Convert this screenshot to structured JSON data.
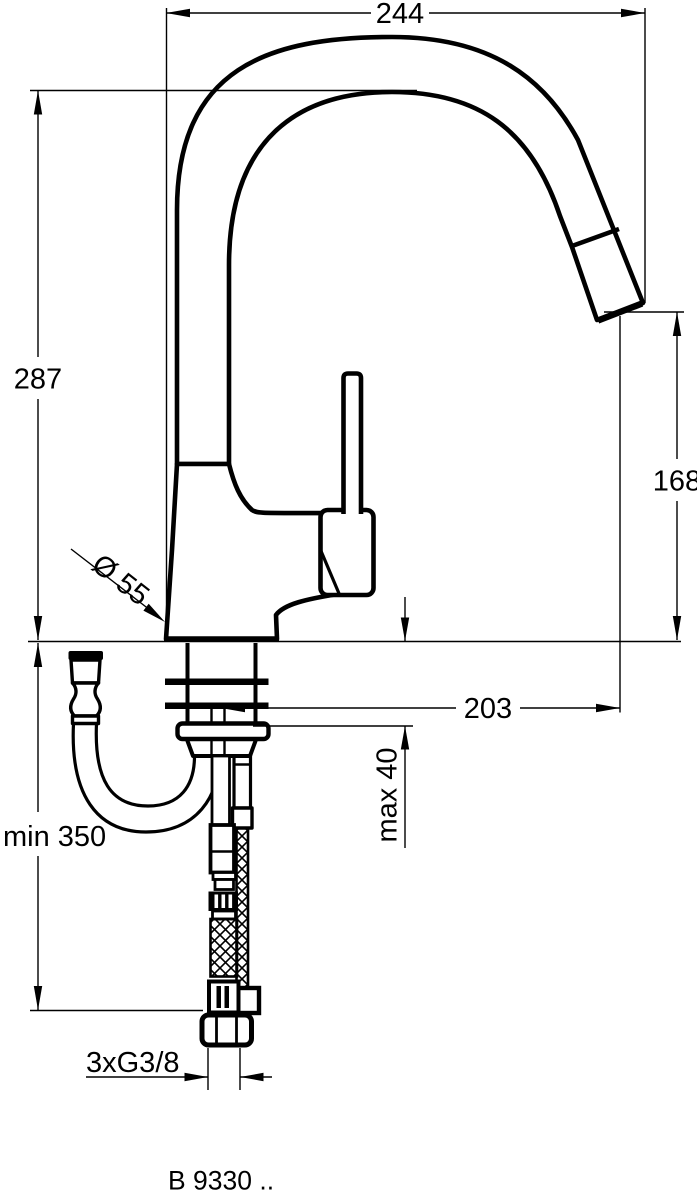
{
  "drawing": {
    "product_code": "B 9330 ..",
    "dimensions": {
      "overall_width": "244",
      "height_to_spout_top": "287",
      "spout_outlet_height": "168",
      "base_diameter": "Ø 55",
      "spout_projection": "203",
      "max_deck_thickness": "max 40",
      "min_clearance_below": "min 350",
      "supply_connection": "3xG3/8"
    },
    "colors": {
      "line": "#000000",
      "background": "#ffffff"
    }
  }
}
